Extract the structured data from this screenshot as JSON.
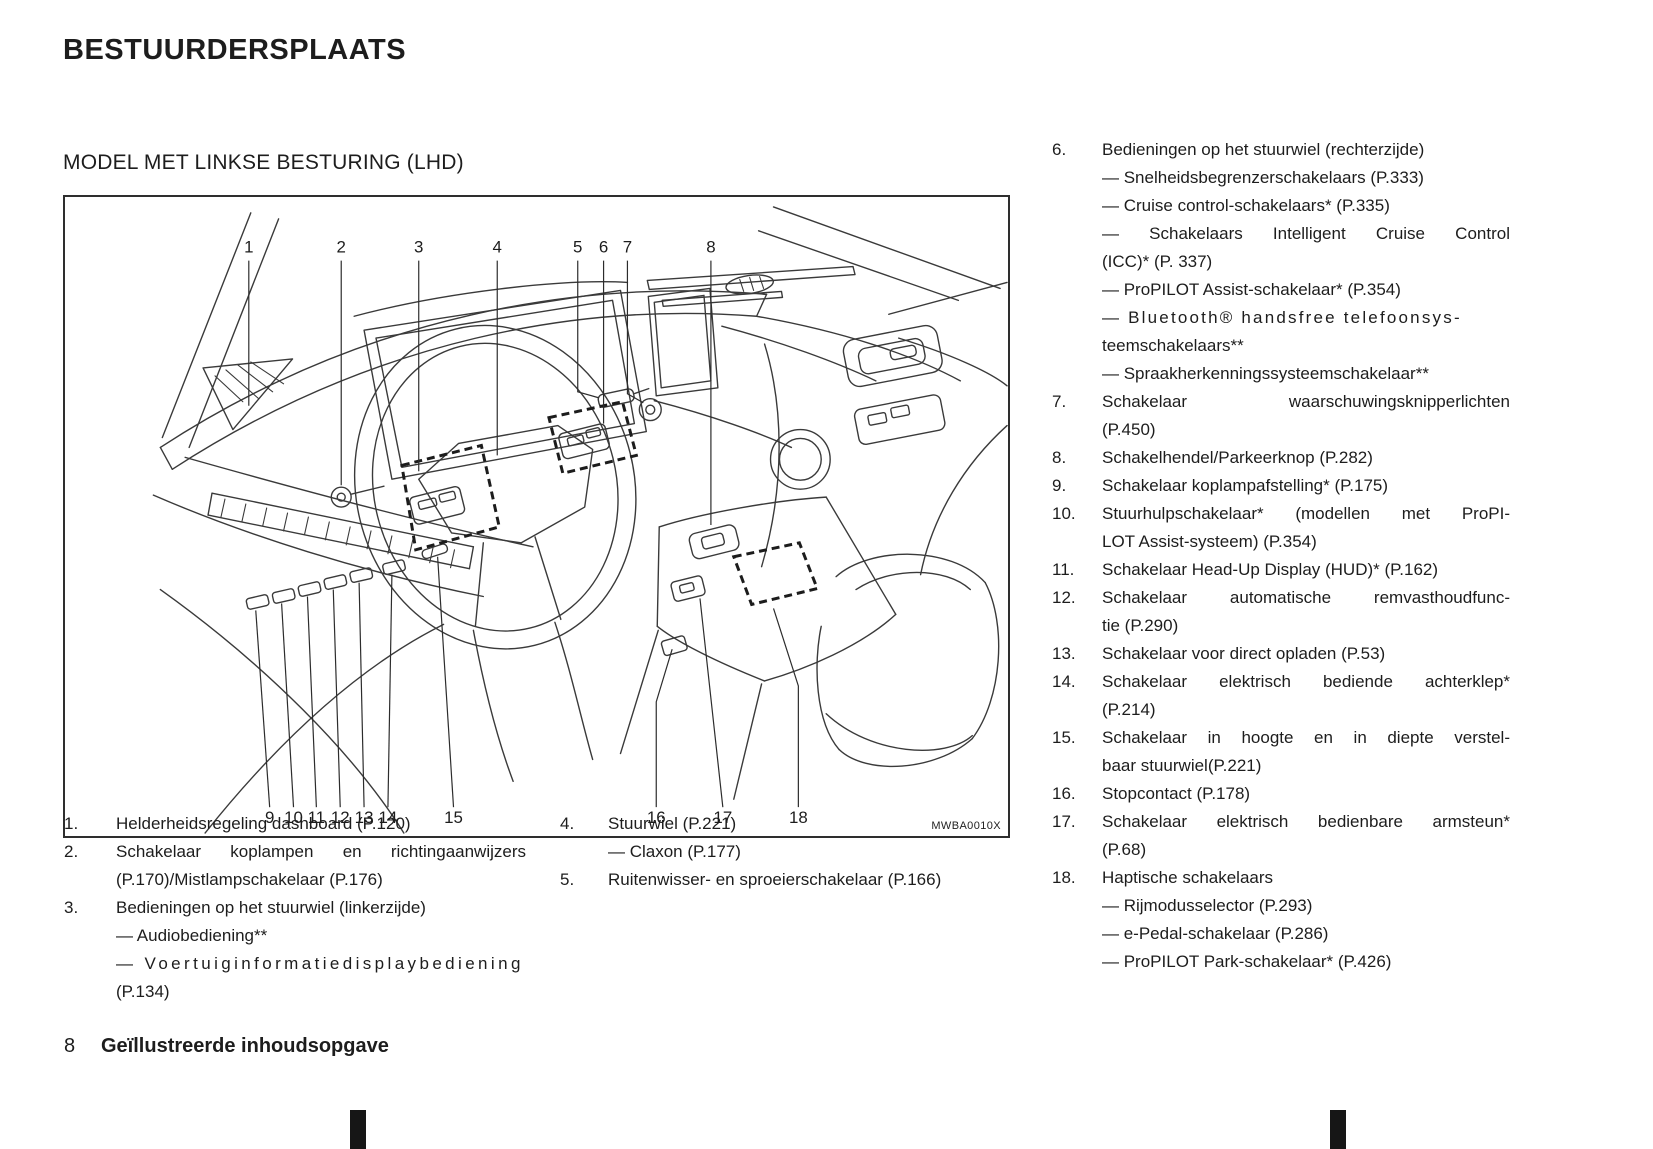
{
  "page": {
    "title": "BESTUURDERSPLAATS",
    "subtitle": "MODEL MET LINKSE BESTURING (LHD)",
    "footer": {
      "page_number": "8",
      "section": "Geïllustreerde inhoudsopgave"
    }
  },
  "diagram": {
    "figure_code": "MWBA0010X",
    "callouts_top": [
      "1",
      "2",
      "3",
      "4",
      "5",
      "6",
      "7",
      "8"
    ],
    "callouts_bottom": [
      "9",
      "10",
      "11",
      "12",
      "13",
      "14",
      "15",
      "16",
      "17",
      "18"
    ]
  },
  "legend": {
    "col1": [
      {
        "num": "1.",
        "lines": [
          "Helderheidsregeling dashboard (P.120)"
        ]
      },
      {
        "num": "2.",
        "lines": [
          "Schakelaar koplampen en richtingaanwijzers",
          "(P.170)/Mistlampschakelaar (P.176)"
        ]
      },
      {
        "num": "3.",
        "lines": [
          "Bedieningen op het stuurwiel (linkerzijde)",
          "— Audiobediening**",
          "— Voertuiginformatiedisplaybediening",
          "(P.134)"
        ]
      }
    ],
    "col2": [
      {
        "num": "4.",
        "lines": [
          "Stuurwiel (P.221)",
          "— Claxon (P.177)"
        ]
      },
      {
        "num": "5.",
        "lines": [
          "Ruitenwisser- en sproeierschakelaar (P.166)"
        ]
      }
    ],
    "col3": [
      {
        "num": "6.",
        "lines": [
          "Bedieningen op het stuurwiel (rechterzijde)",
          "— Snelheidsbegrenzerschakelaars (P.333)",
          "— Cruise control-schakelaars* (P.335)",
          "— Schakelaars Intelligent Cruise Control",
          "(ICC)* (P. 337)",
          "— ProPILOT Assist-schakelaar* (P.354)",
          "— Bluetooth® handsfree telefoonsys-",
          "teemschakelaars**",
          "— Spraakherkenningssysteemschakelaar**"
        ]
      },
      {
        "num": "7.",
        "lines": [
          "Schakelaar waarschuwingsknipperlichten",
          "(P.450)"
        ]
      },
      {
        "num": "8.",
        "lines": [
          "Schakelhendel/Parkeerknop (P.282)"
        ]
      },
      {
        "num": "9.",
        "lines": [
          "Schakelaar koplampafstelling* (P.175)"
        ]
      },
      {
        "num": "10.",
        "lines": [
          "Stuurhulpschakelaar* (modellen met ProPI-",
          "LOT Assist-systeem) (P.354)"
        ]
      },
      {
        "num": "11.",
        "lines": [
          "Schakelaar Head-Up Display (HUD)* (P.162)"
        ]
      },
      {
        "num": "12.",
        "lines": [
          "Schakelaar automatische remvasthoudfunc-",
          "tie (P.290)"
        ]
      },
      {
        "num": "13.",
        "lines": [
          "Schakelaar voor direct opladen (P.53)"
        ]
      },
      {
        "num": "14.",
        "lines": [
          "Schakelaar elektrisch bediende achterklep*",
          "(P.214)"
        ]
      },
      {
        "num": "15.",
        "lines": [
          "Schakelaar in hoogte en in diepte verstel-",
          "baar stuurwiel(P.221)"
        ]
      },
      {
        "num": "16.",
        "lines": [
          "Stopcontact (P.178)"
        ]
      },
      {
        "num": "17.",
        "lines": [
          "Schakelaar elektrisch bedienbare armsteun*",
          "(P.68)"
        ]
      },
      {
        "num": "18.",
        "lines": [
          "Haptische schakelaars",
          "— Rijmodusselector (P.293)",
          "— e-Pedal-schakelaar (P.286)",
          "— ProPILOT Park-schakelaar* (P.426)"
        ]
      }
    ]
  },
  "colors": {
    "ink": "#1d1d1d",
    "line_art": "#3a3a3a"
  }
}
